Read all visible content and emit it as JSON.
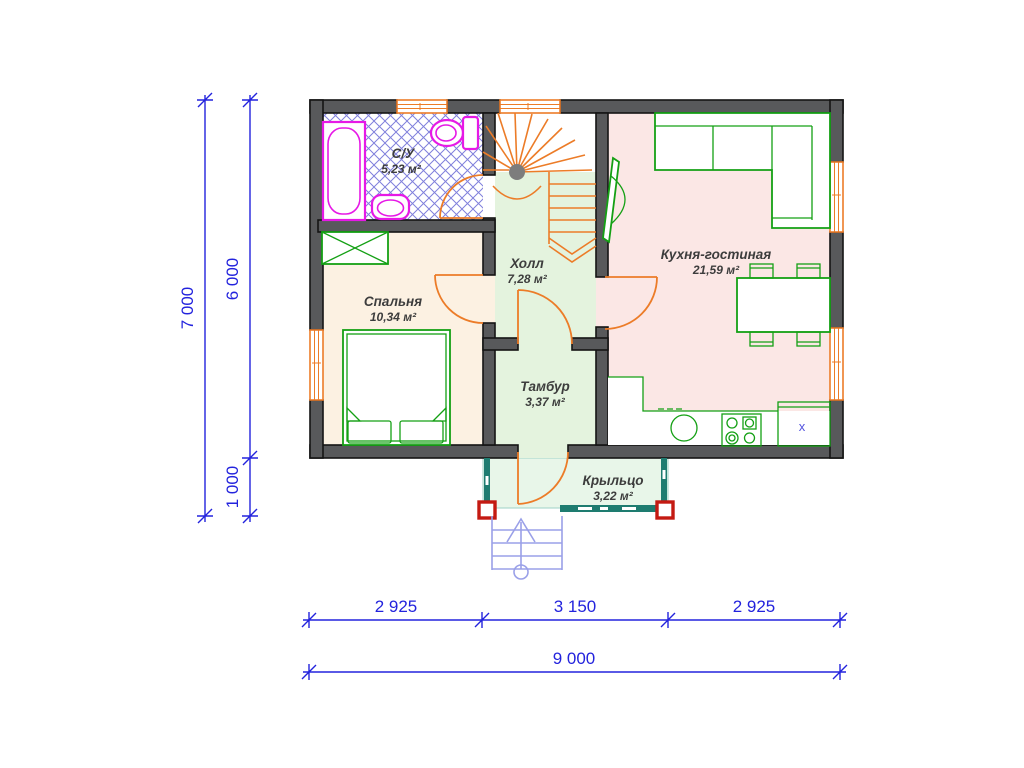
{
  "rooms": {
    "bathroom": {
      "name": "С/У",
      "area": "5,23 м²"
    },
    "bedroom": {
      "name": "Спальня",
      "area": "10,34 м²"
    },
    "hall": {
      "name": "Холл",
      "area": "7,28 м²"
    },
    "kitchen": {
      "name": "Кухня-гостиная",
      "area": "21,59 м²"
    },
    "vestibule": {
      "name": "Тамбур",
      "area": "3,37 м²"
    },
    "porch": {
      "name": "Крыльцо",
      "area": "3,22 м²"
    }
  },
  "dimensions": {
    "total_height": "7 000",
    "house_height": "6 000",
    "porch_depth": "1 000",
    "bottom_left": "2 925",
    "bottom_center": "3 150",
    "bottom_right": "2 925",
    "total_width": "9 000"
  },
  "marks": {
    "fridge": "x"
  },
  "colors": {
    "wall": "#58595b",
    "orange": "#ec7c28",
    "green": "#14a014",
    "magenta": "#e619e6",
    "dim_blue": "#2323dd",
    "tile_blue": "#8080dc",
    "porch_teal": "#1e7c70",
    "post_red": "#c41a12",
    "step_lavender": "#9aa0e8",
    "fill_bedroom": "#fcf1e2",
    "fill_kitchen": "#fbe7e5",
    "fill_hall": "#e4f3de",
    "fill_porch": "#e8f6e9",
    "label": "#3d3d3d"
  }
}
